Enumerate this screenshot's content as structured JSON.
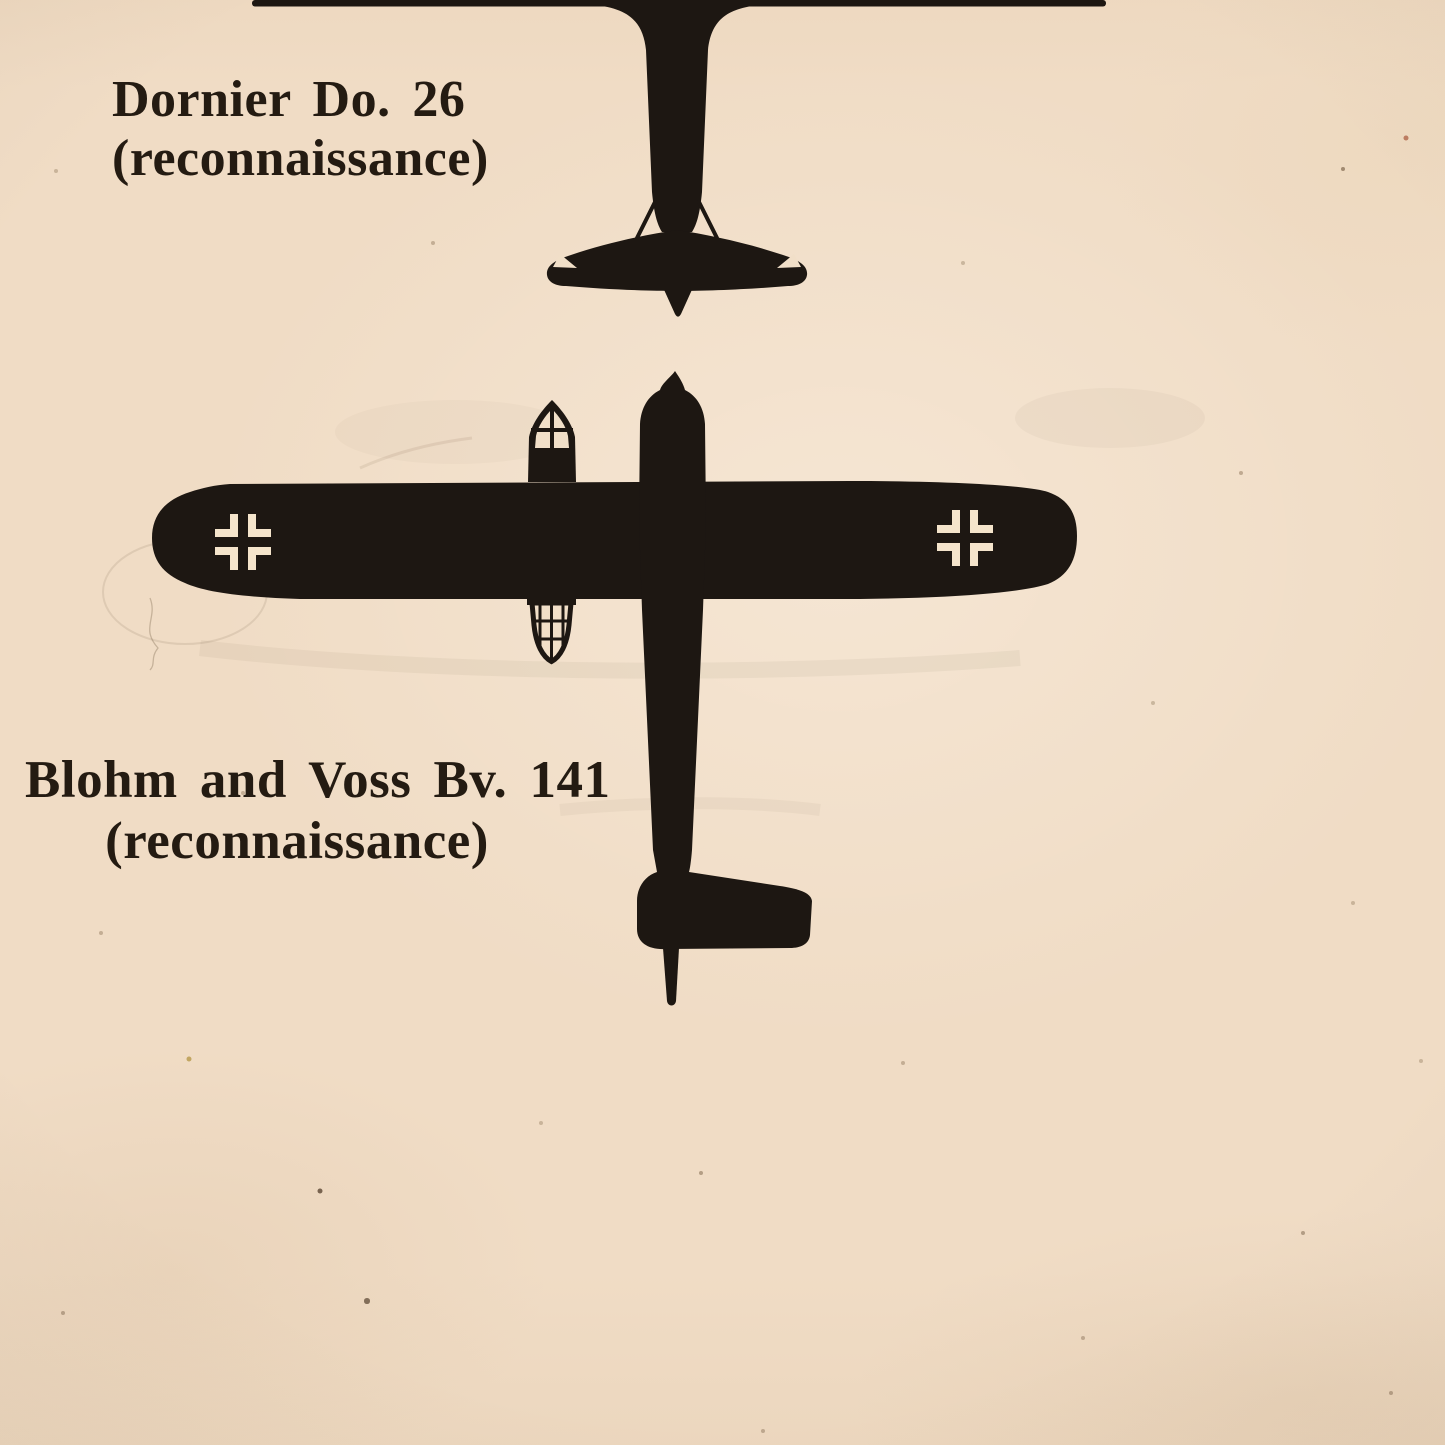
{
  "page": {
    "paper_color": "#f0dcc5",
    "ink_color": "#1d1712",
    "marking_color": "#f4e4cb"
  },
  "aircraft_entries": [
    {
      "name": "Dornier Do. 26",
      "role": "(reconnaissance)",
      "silhouette_icon": "dornier-do-26-plan-silhouette"
    },
    {
      "name": "Blohm and Voss Bv. 141",
      "role": "(reconnaissance)",
      "silhouette_icon": "blohm-and-voss-bv-141-plan-silhouette"
    }
  ],
  "markings": {
    "left_wing_cross": "balkenkreuz-icon",
    "right_wing_cross": "balkenkreuz-icon"
  }
}
